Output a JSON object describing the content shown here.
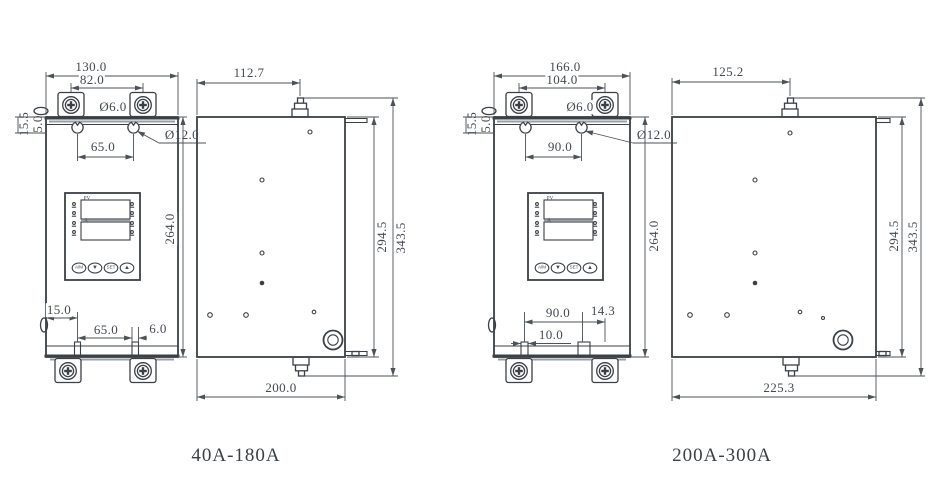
{
  "captions": {
    "unit1": "40A-180A",
    "unit2": "200A-300A"
  },
  "unit1": {
    "front": {
      "overall_width": "130.0",
      "mount_spacing": "82.0",
      "mount_hole_dia": "Ø6.0",
      "hang_hole_dia": "Ø12.0",
      "keyhole_spacing": "65.0",
      "top_offset": "15.5",
      "hanger_thickness": "5.0",
      "body_height": "264.0",
      "foot_left_offset": "15.0",
      "foot_spacing": "65.0",
      "slot_width": "6.0"
    },
    "side": {
      "depth_to_stud": "112.7",
      "mount_height": "294.5",
      "overall_height": "343.5",
      "overall_depth": "200.0"
    }
  },
  "unit2": {
    "front": {
      "overall_width": "166.0",
      "mount_spacing": "104.0",
      "mount_hole_dia": "Ø6.0",
      "hang_hole_dia": "Ø12.0",
      "keyhole_spacing": "90.0",
      "top_offset": "15.5",
      "hanger_thickness": "5.0",
      "body_height": "264.0",
      "foot_spacing": "90.0",
      "slot_width": "14.3",
      "foot_left_offset": "10.0"
    },
    "side": {
      "depth_to_stud": "125.2",
      "mount_height": "294.5",
      "overall_height": "343.5",
      "overall_depth": "225.3"
    }
  },
  "panel": {
    "display_top_label": "PV",
    "display_bottom_label": "A",
    "button_auto_manual": "A/M",
    "button_down": "▼",
    "button_set": "SET",
    "button_up": "▲"
  }
}
